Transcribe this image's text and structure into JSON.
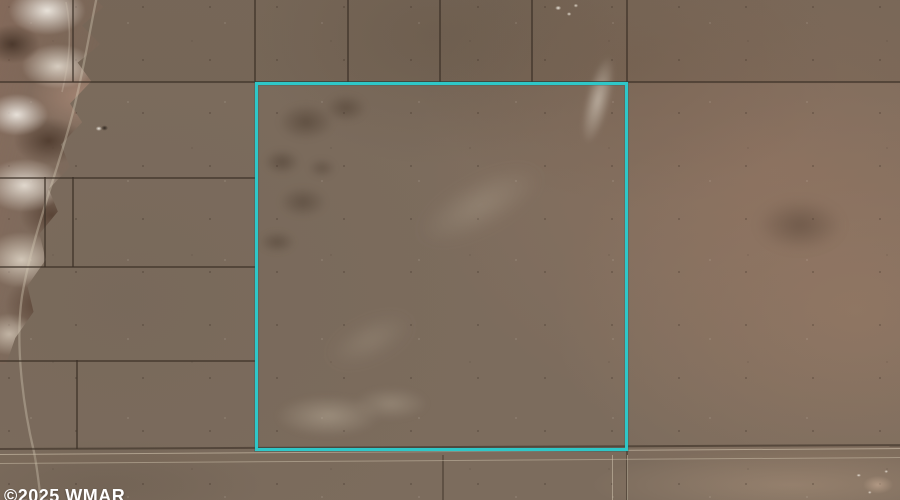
{
  "page": {
    "width": 900,
    "height": 500
  },
  "map": {
    "kind": "aerial-satellite-parcel-photo",
    "watermark": {
      "text": "©2025 WMAR"
    },
    "features": {
      "highlighted_parcel": "square vacant-land parcel outlined in cyan",
      "terrain": [
        "badlands ridge northwest",
        "open desert scrub plain",
        "dark brush mottling",
        "light dirt trail"
      ],
      "roads": [
        "east-west dirt road along south boundary",
        "north-south dirt road at southeast corner"
      ],
      "structure": "small isolated structure west of parcel"
    },
    "colors": {
      "terrain-base": "#7c6c5d",
      "terrain-right-tint": "#96755f",
      "parcel-line": "#3c3026",
      "boundary-highlight": "#2ec7c8",
      "road-edge": "#d8ccb6",
      "badlands-light": "#e9e3d8",
      "badlands-shadow": "#4a3830",
      "badlands-rose": "#b08a77",
      "watermark-text": "#ffffff"
    }
  }
}
